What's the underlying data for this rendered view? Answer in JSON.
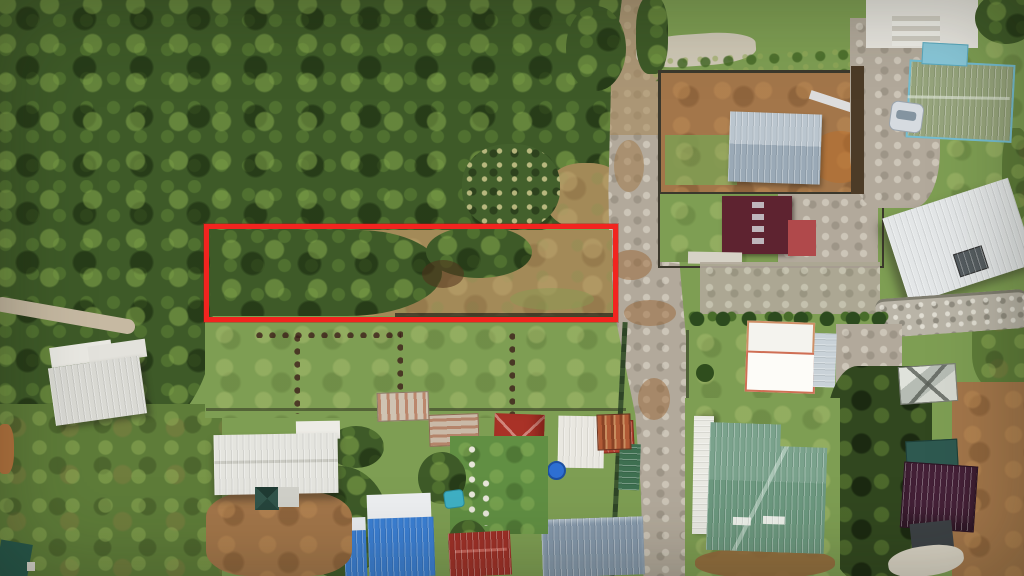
{
  "scene": {
    "type": "aerial-drone-photograph",
    "description": "Top-down drone photo of a rural neighborhood: dense forest on the left, a gravel road running vertically on the right, tin-roofed houses and yards, and a land parcel outlined with a red rectangle.",
    "annotation": {
      "name": "parcel-boundary-highlight",
      "shape": "rectangle",
      "stroke_color": "#f2241f",
      "description": "Red rectangle outlining a long narrow land parcel, left portion forested, right portion cleared dirt"
    },
    "palette": {
      "forest_green": "#3e5a28",
      "field_green": "#7e9e53",
      "dry_grass_tan": "#a38a58",
      "dirt_brown": "#a3764a",
      "road_gravel": "#b2a99b",
      "highlight_red": "#f2241f",
      "gray_roof": "#9aa9b6",
      "maroon_roof": "#5e2330",
      "sage_roof": "#96a47c",
      "teal_roof": "#6c987f",
      "blue_roof": "#3b7fd4",
      "crimson_roof": "#9f3028",
      "plum_roof": "#452138",
      "slate_roof": "#8598ab",
      "white_roof": "#e4e4de"
    }
  },
  "features": {
    "parcel": "Highlighted land parcel outlined in red",
    "parcel_trees": "Forested left portion of highlighted parcel",
    "parcel_clearing": "Cleared dirt portion of highlighted parcel",
    "forest": "Dense tropical forest canopy",
    "palm_grove": "Palm grove",
    "road": "Gravel road",
    "warehouse": "Warehouse with gray metal roof in fenced dirt lot",
    "maroon_house": "House with maroon metal roof and red annex",
    "green_roof_house": "House with sage-green roof and light-blue trim",
    "car": "Parked silver car",
    "deck": "White deck with concrete steps",
    "white_roof_building": "Large building with white metal roof and dark skylight",
    "stone_path": "Stone riprap path",
    "twin_white_house": "House with twin white roof panels and red trim",
    "hedge": "Trimmed hedge row",
    "greenhouse": "Small greenhouse with X-braced translucent roof",
    "plum_roof_house": "House with dark plum corrugated roof",
    "tarp": "Dark tarp shelter",
    "teal_structure": "Dark teal flat structure",
    "teal_roof_building": "L-shaped building with teal metal roof and skylight strips",
    "narrow_white_building": "Long narrow building with white roof",
    "red_hip_house": "House with red hip roof",
    "blue_roof_building": "Building with blue metal roof and white ridge caps",
    "teal_pool": "Small teal pool",
    "crimson_roof_house": "House with crimson metal roof",
    "slate_roof_building": "Building with slate-blue metal roof",
    "white_canopy": "White canopy with rusty corrugated section",
    "blue_tank": "Blue water tank",
    "farmhouse": "Long farmhouse with white metal roof",
    "gazebo": "Small dark-teal pyramid gazebo",
    "patio": "Concrete patio slab",
    "left_white_building": "Building with weathered white metal roof",
    "rusty_shed": "Shed with rusty corrugated roof",
    "field": "Cleared grass field with rows of planted seedlings",
    "garden": "Garden plot with stepping-stone path",
    "dirt_path": "Dirt footpath",
    "fence": "Property fence line",
    "gravel_yard": "Gravel yard / driveway",
    "teal_corner_roof": "Teal roof at image corner"
  }
}
